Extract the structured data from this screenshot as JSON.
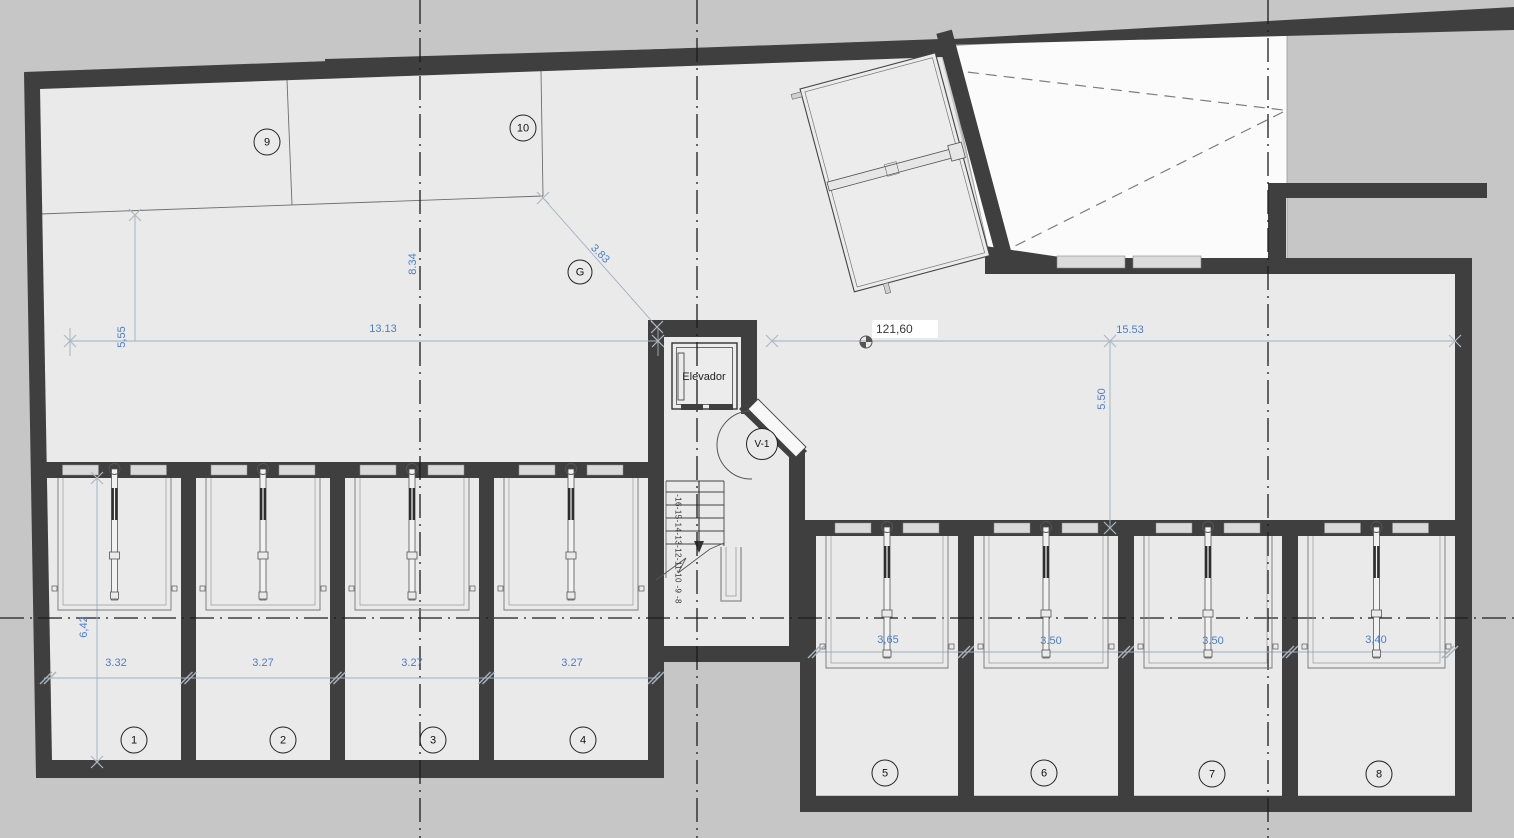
{
  "plan": {
    "elevator_label": "Elevador",
    "level_marker": "121,60",
    "stair_numbers": "-16-15-14-13-12-11-10 -9 -8",
    "door_label": "V-1",
    "grid_label": "G",
    "spaces": [
      "1",
      "2",
      "3",
      "4",
      "5",
      "6",
      "7",
      "8",
      "9",
      "10"
    ],
    "dims": {
      "upper_left_height": "5,55",
      "upper_left_width": "13.13",
      "grid_span": "8.34",
      "diagonal": "3.83",
      "right_width": "15.53",
      "right_height": "5.50",
      "unit_depth": "6,42",
      "left_units": [
        "3.32",
        "3.27",
        "3.27",
        "3.27"
      ],
      "right_units": [
        "3,65",
        "3.50",
        "3.50",
        "3,40"
      ]
    },
    "colors": {
      "wall": "#3f3f3f",
      "floor": "#eaeaea",
      "background": "#c6c6c6",
      "ramp": "#fbfbfb",
      "dimension_text": "#4d7ec6"
    }
  }
}
